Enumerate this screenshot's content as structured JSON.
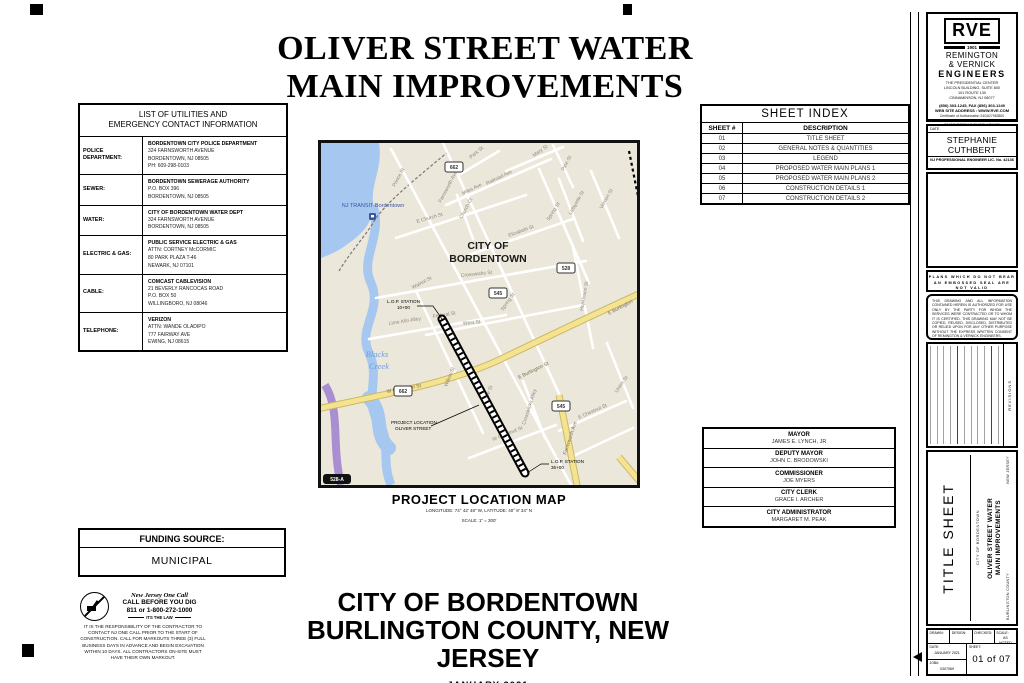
{
  "title": {
    "line1": "OLIVER STREET WATER",
    "line2": "MAIN IMPROVEMENTS"
  },
  "utilities": {
    "header1": "LIST OF UTILITIES AND",
    "header2": "EMERGENCY CONTACT INFORMATION",
    "rows": [
      {
        "label": "POLICE DEPARTMENT:",
        "l0": "BORDENTOWN CITY POLICE DEPARTMENT",
        "l1": "324 FARNSWORTH AVENUE",
        "l2": "BORDENTOWN, NJ  08505",
        "l3": "PH: 609-298-0103"
      },
      {
        "label": "SEWER:",
        "l0": "BORDENTOWN SEWERAGE AUTHORITY",
        "l1": "P.O. BOX 396",
        "l2": "BORDENTOWN, NJ 08505"
      },
      {
        "label": "WATER:",
        "l0": "CITY OF BORDENTOWN WATER DEPT",
        "l1": "324 FARNSWORTH AVENUE",
        "l2": "BORDENTOWN, NJ 08505"
      },
      {
        "label": "ELECTRIC & GAS:",
        "l0": "PUBLIC SERVICE ELECTRIC & GAS",
        "l1": "ATTN: CORTNEY McCORMIC",
        "l2": "80 PARK PLAZA T-46",
        "l3": "NEWARK, NJ 07101"
      },
      {
        "label": "CABLE:",
        "l0": "COMCAST CABLEVISION",
        "l1": "21 BEVERLY RANCOCAS ROAD",
        "l2": "P.O. BOX 50",
        "l3": "WILLINGBORO, NJ 08046"
      },
      {
        "label": "TELEPHONE:",
        "l0": "VERIZON",
        "l1": "ATTN: WANDE OLADIPO",
        "l2": "777 FAIRWAY AVE",
        "l3": "EWING, NJ 08615"
      }
    ]
  },
  "sheet_index": {
    "title": "SHEET INDEX",
    "col1": "SHEET #",
    "col2": "DESCRIPTION",
    "rows": [
      {
        "num": "01",
        "desc": "TITLE SHEET"
      },
      {
        "num": "02",
        "desc": "GENERAL NOTES & QUANTITIES"
      },
      {
        "num": "03",
        "desc": "LEGEND"
      },
      {
        "num": "04",
        "desc": "PROPOSED WATER MAIN PLANS 1"
      },
      {
        "num": "05",
        "desc": "PROPOSED WATER MAIN PLANS 2"
      },
      {
        "num": "06",
        "desc": "CONSTRUCTION DETAILS 1"
      },
      {
        "num": "07",
        "desc": "CONSTRUCTION DETAILS 2"
      }
    ]
  },
  "map": {
    "title": "PROJECT LOCATION MAP",
    "coords": "LONGITUDE:  74° 42' 48\" W,  LATITUDE:  40° 8' 34\" N",
    "scale": "SCALE:  1\" = 300'",
    "city1": "CITY OF",
    "city2": "BORDENTOWN",
    "transit": "NJ TRANSIT-Bordentown",
    "creek1": "Blacks",
    "creek2": "Creek",
    "lop_start1": "L.O.P.  STATION",
    "lop_start2": "10+00",
    "lop_end1": "L.O.P.  STATION",
    "lop_end2": "36+00",
    "proj1": "PROJECT  LOCATION",
    "proj2": "OLIVER  STREET",
    "badge": "528-A",
    "shields": [
      {
        "num": "662"
      },
      {
        "num": "528"
      },
      {
        "num": "545"
      },
      {
        "num": "662"
      },
      {
        "num": "545"
      }
    ],
    "streets": [
      {
        "t": "Park St"
      },
      {
        "t": "Mary St"
      },
      {
        "t": "Pine St"
      },
      {
        "t": "Railroad Ave"
      },
      {
        "t": "Miles Ave"
      },
      {
        "t": "Prince St"
      },
      {
        "t": "Farnsworth Ave"
      },
      {
        "t": "Spring St"
      },
      {
        "t": "Vernon St"
      },
      {
        "t": "Lafayette St"
      },
      {
        "t": "E Church St"
      },
      {
        "t": "Church Ct"
      },
      {
        "t": "Elizabeth St"
      },
      {
        "t": "Walnut St"
      },
      {
        "t": "Crosswicks St"
      },
      {
        "t": "Spring St"
      },
      {
        "t": "Hopkinson St"
      },
      {
        "t": "West St"
      },
      {
        "t": "Lime Kiln Alley"
      },
      {
        "t": "Federal St"
      },
      {
        "t": "Willow St"
      },
      {
        "t": "Prince St"
      },
      {
        "t": "W Burlington St"
      },
      {
        "t": "E Burlington St"
      },
      {
        "t": "E Burlington"
      },
      {
        "t": "Farnsworth Ave"
      },
      {
        "t": "Crosswicks Alley"
      },
      {
        "t": "W Chestnut St"
      },
      {
        "t": "E Chestnut St"
      },
      {
        "t": "Union St"
      }
    ]
  },
  "officials": {
    "rows": [
      {
        "title": "MAYOR",
        "name": "JAMES E. LYNCH, JR"
      },
      {
        "title": "DEPUTY MAYOR",
        "name": "JOHN C. BRODOWSKI"
      },
      {
        "title": "COMMISSIONER",
        "name": "JOE MYERS"
      },
      {
        "title": "CITY CLERK",
        "name": "GRACE I. ARCHER"
      },
      {
        "title": "CITY ADMINISTRATOR",
        "name": "MARGARET M. PEAK"
      }
    ]
  },
  "funding": {
    "label": "FUNDING SOURCE:",
    "value": "MUNICIPAL"
  },
  "one_call": {
    "name": "New Jersey One Call",
    "line1": "CALL BEFORE YOU DIG",
    "line2": "811 or 1-800-272-1000",
    "law": "ITS THE LAW",
    "body": "IT IS THE RESPONSIBILITY OF THE CONTRACTOR TO CONTACT NJ ONE CALL PRIOR TO THE START OF CONSTRUCTION. CALL FOR MARKOUTS THREE (3) FULL BUSINESS DAYS IN ADVANCE AND BEGIN EXCAVATION WITHIN 10 DAYS. ALL CONTRACTORS ON-SITE MUST HAVE THEIR OWN MARKOUT."
  },
  "footer": {
    "city": "CITY OF BORDENTOWN",
    "county": "BURLINGTON COUNTY, NEW JERSEY",
    "date": "JANUARY 2021"
  },
  "firm": {
    "logo": "RVE",
    "year": "1901",
    "name1": "REMINGTON",
    "name2": "& VERNICK",
    "name3": "ENGINEERS",
    "addr1": "THE PRESIDENTIAL CENTER",
    "addr2": "LINCOLN BUILDING, SUITE 800",
    "addr3": "101 ROUTE 130",
    "addr4": "CINNAMINSON, NJ 08077",
    "phone": "(856) 303-1245, FAX (856) 303-1249",
    "web": "WEB SITE ADDRESS : WWW.RVE.COM",
    "cert": "Certificate of Authorization 24GA27983800",
    "motto": "~ENGINEERING EXCELLENCE~"
  },
  "engineer": {
    "date_label": "DATE",
    "name": "STEPHANIE CUTHBERT",
    "license": "NJ PROFESSIONAL ENGINEER LIC. No. 42136"
  },
  "seal_note": {
    "line1": "PLANS WHICH DO NOT BEAR",
    "line2": "AN EMBOSSED SEAL ARE NOT VALID"
  },
  "disclaimer": "THIS DRAWING AND ALL INFORMATION CONTAINED HEREIN IS AUTHORIZED FOR USE ONLY BY THE PARTY FOR WHOM THE SERVICES WERE CONTRACTED OR TO WHOM IT IS CERTIFIED. THIS DRAWING MAY NOT BE COPIED, REUSED, DISCLOSED, DISTRIBUTED OR RELIED UPON FOR ANY OTHER PURPOSE WITHOUT THE EXPRESS WRITTEN CONSENT OF REMINGTON & VERNICK ENGINEERS.",
  "revisions_label": "REVISIONS",
  "titleblock": {
    "sheet_title": "TITLE SHEET",
    "client": "CITY OF BORDENTOWN",
    "project1": "OLIVER STREET WATER",
    "project2": "MAIN IMPROVEMENTS",
    "county": "BURLINGTON COUNTY",
    "state": "NEW JERSEY"
  },
  "infoblock": {
    "drawn_label": "DRAWN:",
    "design_label": "DESIGN:",
    "checked_label": "CHECKED:",
    "scale_label": "SCALE:",
    "scale_value": "AS NOTED",
    "date_label": "DATE:",
    "date_value": "JANUARY 2021",
    "job_label": "JOB#:",
    "job_value": "0307069",
    "sheet_label": "SHEET:",
    "sheet_value": "01  of  07"
  }
}
